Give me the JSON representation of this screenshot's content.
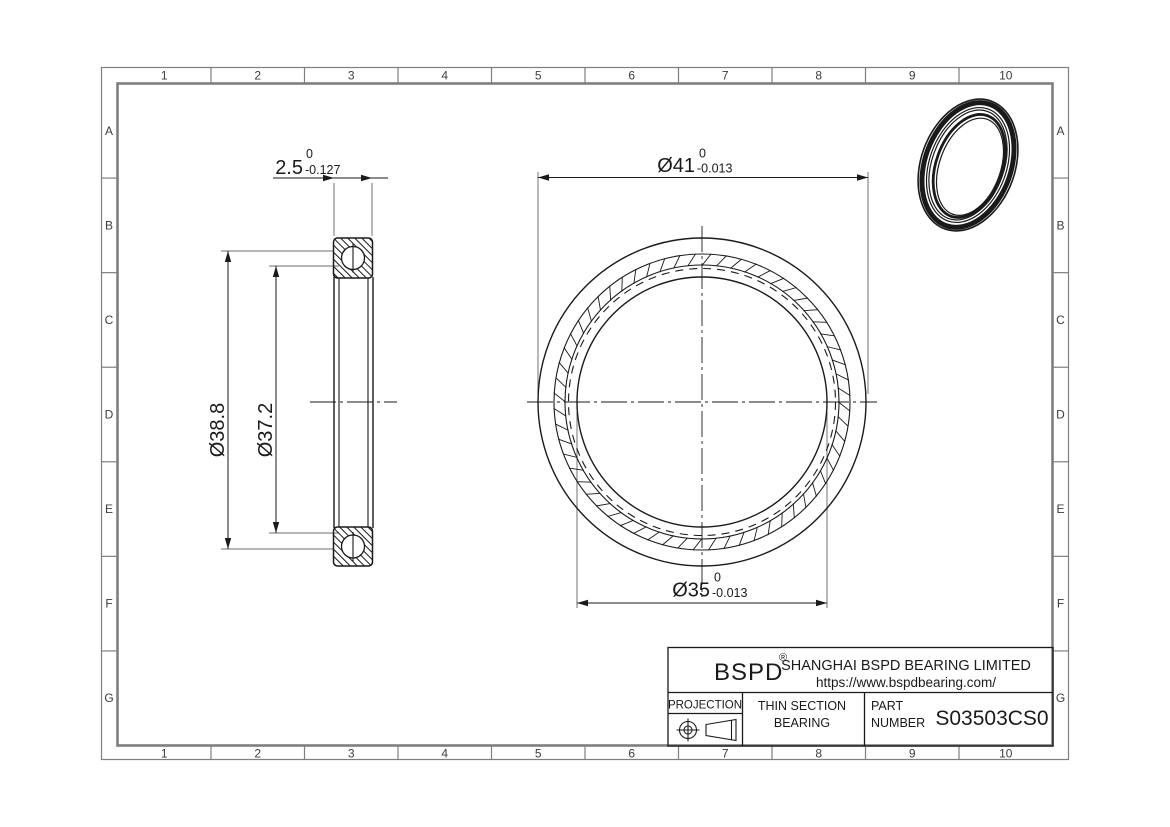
{
  "drawing": {
    "grid": {
      "columns": [
        "1",
        "2",
        "3",
        "4",
        "5",
        "6",
        "7",
        "8",
        "9",
        "10"
      ],
      "rows": [
        "A",
        "B",
        "C",
        "D",
        "E",
        "F",
        "G"
      ]
    },
    "dimensions": {
      "width": {
        "value": "2.5",
        "upper_tol": "0",
        "lower_tol": "-0.127"
      },
      "outer_diameter": {
        "value": "Ø41",
        "upper_tol": "0",
        "lower_tol": "-0.013"
      },
      "bore_diameter": {
        "value": "Ø35",
        "upper_tol": "0",
        "lower_tol": "-0.013"
      },
      "outer_race_diameter": {
        "value": "Ø38.8"
      },
      "inner_race_diameter": {
        "value": "Ø37.2"
      }
    },
    "title_block": {
      "logo": "BSPD",
      "registered_mark": "®",
      "company": "SHANGHAI BSPD BEARING LIMITED",
      "website": "https://www.bspdbearing.com/",
      "projection_label": "PROJECTION",
      "product_line1": "THIN SECTION",
      "product_line2": "BEARING",
      "part_label_line1": "PART",
      "part_label_line2": "NUMBER",
      "part_number": "S03503CS0"
    },
    "colors": {
      "line": "#1a1a1a",
      "frame": "#7f7f7f",
      "extension": "#8a8a8a",
      "background": "#ffffff"
    }
  }
}
